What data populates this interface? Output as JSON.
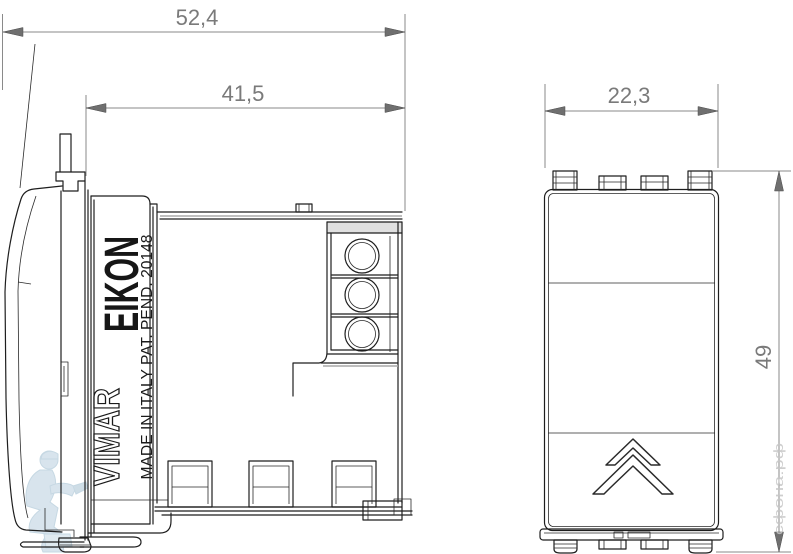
{
  "meta": {
    "background_color": "#ffffff",
    "drawing_line_color": "#1e1e1e",
    "dimension_color": "#7a7a7a",
    "watermark_color": "#b3cadc"
  },
  "dimensions": {
    "overall_depth": "52,4",
    "body_depth": "41,5",
    "module_width": "22,3",
    "module_height": "49"
  },
  "branding": {
    "series": "EIKON",
    "manufacturer": "VIMAR",
    "origin_note": "MADE IN ITALY PAT. PEND. 20148"
  },
  "watermark": {
    "site_text": "сфона.рф"
  }
}
